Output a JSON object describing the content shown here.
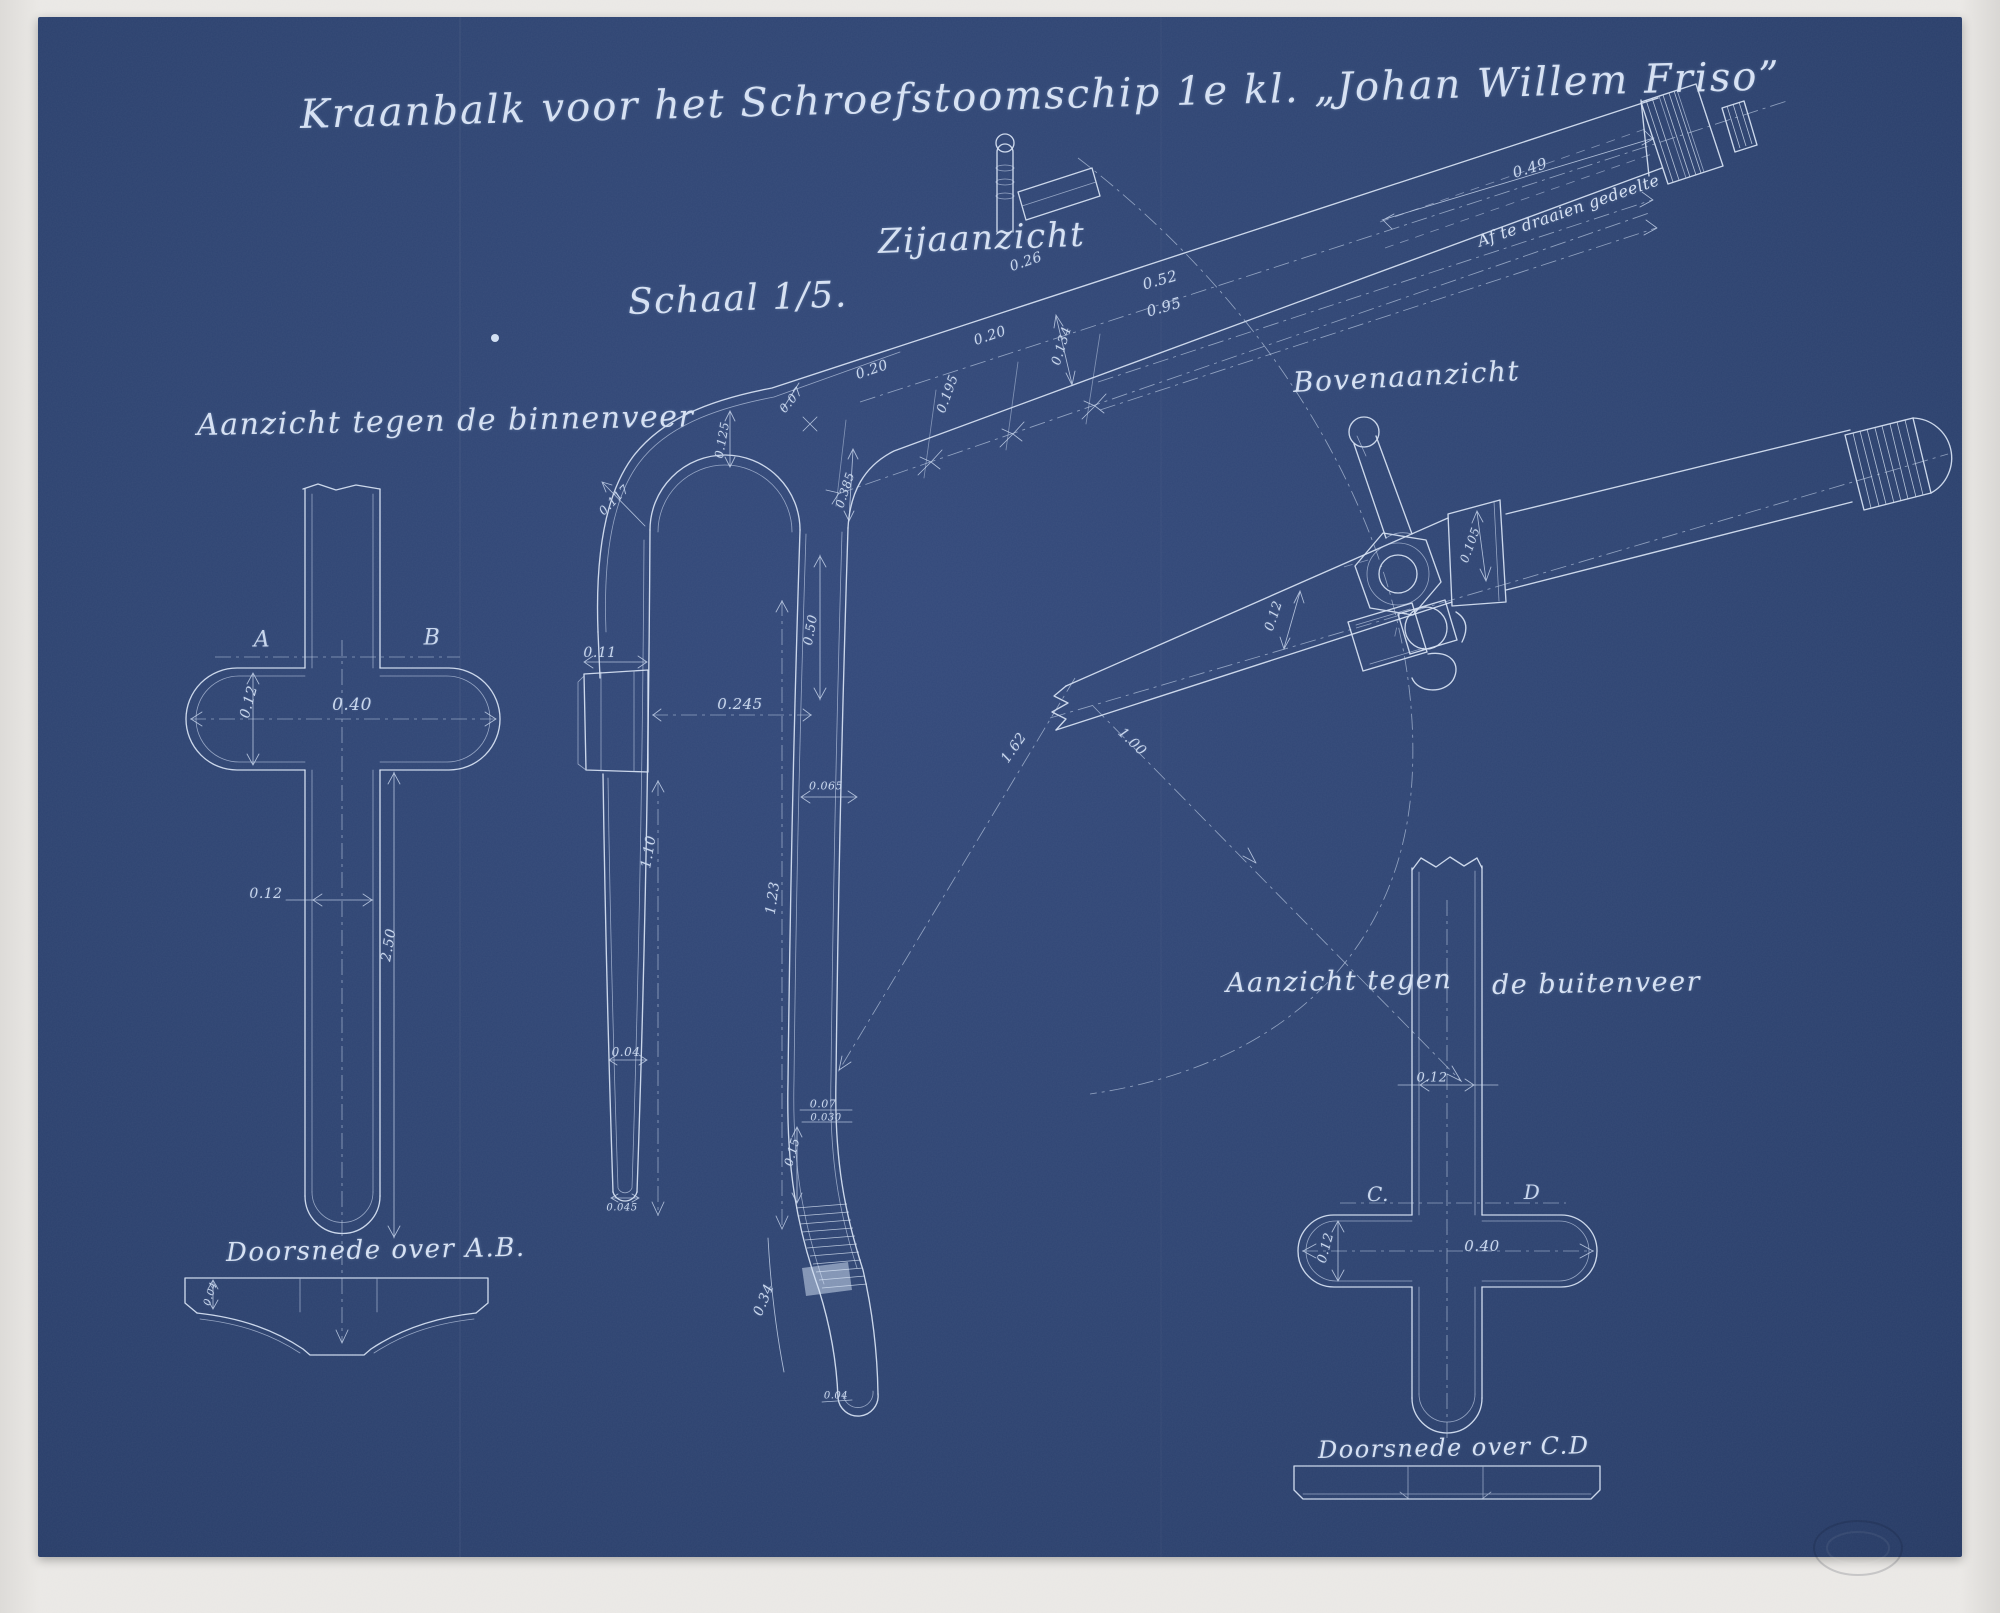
{
  "title": "Kraanbalk voor het Schroefstoomschip 1e kl. „Johan Willem Friso”",
  "labels": {
    "side_view": "Zijaanzicht",
    "scale": "Schaal 1/5.",
    "view_inner_spring": "Aanzicht tegen de binnenveer",
    "top_view": "Bovenaanzicht",
    "view_outer_spring_part1": "Aanzicht tegen",
    "view_outer_spring_part2": "de buitenveer",
    "section_ab": "Doorsnede over A.B.",
    "section_cd": "Doorsnede over C.D",
    "turned_off_part": "Af te draaien gedeelte"
  },
  "colors": {
    "sheet_blue": "#2e4472",
    "ink_white": "#d7e2f3",
    "mat_gray": "#eae8e5"
  },
  "dimensions": [
    {
      "t": "A",
      "x": 262,
      "y": 640,
      "r": 0,
      "s": 22
    },
    {
      "t": "B",
      "x": 432,
      "y": 638,
      "r": 0,
      "s": 22
    },
    {
      "t": "0.40",
      "x": 352,
      "y": 705,
      "r": 0,
      "s": 17
    },
    {
      "t": "0.12",
      "x": 249,
      "y": 702,
      "r": -75,
      "s": 14
    },
    {
      "t": "0.12",
      "x": 266,
      "y": 894,
      "r": 0,
      "s": 14
    },
    {
      "t": "2.50",
      "x": 389,
      "y": 945,
      "r": -80,
      "s": 14
    },
    {
      "t": "0.04",
      "x": 211,
      "y": 1294,
      "r": -72,
      "s": 10
    },
    {
      "t": "0.117",
      "x": 614,
      "y": 500,
      "r": -45,
      "s": 12
    },
    {
      "t": "0.125",
      "x": 722,
      "y": 440,
      "r": -80,
      "s": 12
    },
    {
      "t": "0.07",
      "x": 791,
      "y": 400,
      "r": -50,
      "s": 12
    },
    {
      "t": "0.385",
      "x": 845,
      "y": 490,
      "r": -72,
      "s": 12
    },
    {
      "t": "0.11",
      "x": 600,
      "y": 653,
      "r": 0,
      "s": 14
    },
    {
      "t": "0.245",
      "x": 740,
      "y": 704,
      "r": 0,
      "s": 15
    },
    {
      "t": "0.50",
      "x": 811,
      "y": 630,
      "r": -80,
      "s": 13
    },
    {
      "t": "0.065",
      "x": 826,
      "y": 786,
      "r": 0,
      "s": 11
    },
    {
      "t": "1.10",
      "x": 649,
      "y": 852,
      "r": -80,
      "s": 14
    },
    {
      "t": "1.23",
      "x": 773,
      "y": 898,
      "r": -82,
      "s": 14
    },
    {
      "t": "0.04",
      "x": 626,
      "y": 1052,
      "r": 0,
      "s": 12
    },
    {
      "t": "0.045",
      "x": 622,
      "y": 1208,
      "r": 0,
      "s": 10
    },
    {
      "t": "0.07",
      "x": 823,
      "y": 1104,
      "r": 0,
      "s": 11
    },
    {
      "t": "0.030",
      "x": 826,
      "y": 1118,
      "r": 0,
      "s": 10
    },
    {
      "t": "0.15",
      "x": 792,
      "y": 1152,
      "r": -75,
      "s": 12
    },
    {
      "t": "0.34",
      "x": 764,
      "y": 1300,
      "r": -68,
      "s": 14
    },
    {
      "t": "0.04",
      "x": 836,
      "y": 1396,
      "r": 0,
      "s": 10
    },
    {
      "t": "0.20",
      "x": 872,
      "y": 370,
      "r": -19,
      "s": 14
    },
    {
      "t": "0.195",
      "x": 948,
      "y": 394,
      "r": -70,
      "s": 13
    },
    {
      "t": "0.20",
      "x": 990,
      "y": 336,
      "r": -19,
      "s": 14
    },
    {
      "t": "0.26",
      "x": 1026,
      "y": 262,
      "r": -19,
      "s": 14
    },
    {
      "t": "0.134",
      "x": 1062,
      "y": 346,
      "r": -73,
      "s": 13
    },
    {
      "t": "0.52",
      "x": 1160,
      "y": 280,
      "r": -16,
      "s": 15
    },
    {
      "t": "0.95",
      "x": 1164,
      "y": 307,
      "r": -16,
      "s": 15
    },
    {
      "t": "0.49",
      "x": 1530,
      "y": 168,
      "r": -17,
      "s": 15
    },
    {
      "t": "0.105",
      "x": 1470,
      "y": 545,
      "r": -70,
      "s": 12
    },
    {
      "t": "0.12",
      "x": 1274,
      "y": 616,
      "r": -72,
      "s": 13
    },
    {
      "t": "1.62",
      "x": 1014,
      "y": 748,
      "r": -55,
      "s": 14
    },
    {
      "t": "1.00",
      "x": 1132,
      "y": 742,
      "r": 44,
      "s": 14
    },
    {
      "t": "C.",
      "x": 1378,
      "y": 1194,
      "r": 0,
      "s": 20
    },
    {
      "t": "D",
      "x": 1532,
      "y": 1192,
      "r": 0,
      "s": 20
    },
    {
      "t": "0.40",
      "x": 1482,
      "y": 1246,
      "r": 0,
      "s": 15
    },
    {
      "t": "0.12",
      "x": 1326,
      "y": 1248,
      "r": -75,
      "s": 13
    },
    {
      "t": "0.12",
      "x": 1432,
      "y": 1078,
      "r": 0,
      "s": 13
    }
  ]
}
